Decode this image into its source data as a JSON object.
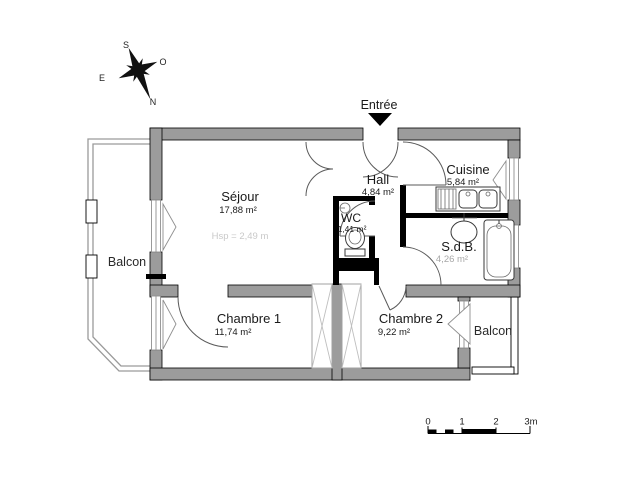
{
  "entry_label": "Entrée",
  "compass": {
    "north": "N",
    "south": "S",
    "east": "E",
    "west": "O"
  },
  "rooms": {
    "sejour": {
      "name": "Séjour",
      "area": "17,88 m²",
      "ceiling_note": "Hsp = 2,49 m"
    },
    "hall": {
      "name": "Hall",
      "area": "4,84 m²"
    },
    "cuisine": {
      "name": "Cuisine",
      "area": "5,84 m²"
    },
    "wc": {
      "name": "WC",
      "area": "1,41 m²"
    },
    "sdb": {
      "name": "S.d.B.",
      "area": "4,26 m²"
    },
    "chambre1": {
      "name": "Chambre 1",
      "area": "11,74 m²"
    },
    "chambre2": {
      "name": "Chambre 2",
      "area": "9,22 m²"
    },
    "balcon_left": {
      "name": "Balcon"
    },
    "balcon_right": {
      "name": "Balcon"
    }
  },
  "scale_bar": {
    "tick0": "0",
    "tick1": "1",
    "tick2": "2",
    "tick3": "3m"
  },
  "colors": {
    "wall_fill": "#9c9c9c",
    "wall_stroke": "#000000",
    "interior_wall": "#000000",
    "door_arc": "#5a5a5a",
    "fixture_stroke": "#3a3a3a",
    "faint_text": "#c9c9c9",
    "muted_text": "#a8a8a8"
  }
}
